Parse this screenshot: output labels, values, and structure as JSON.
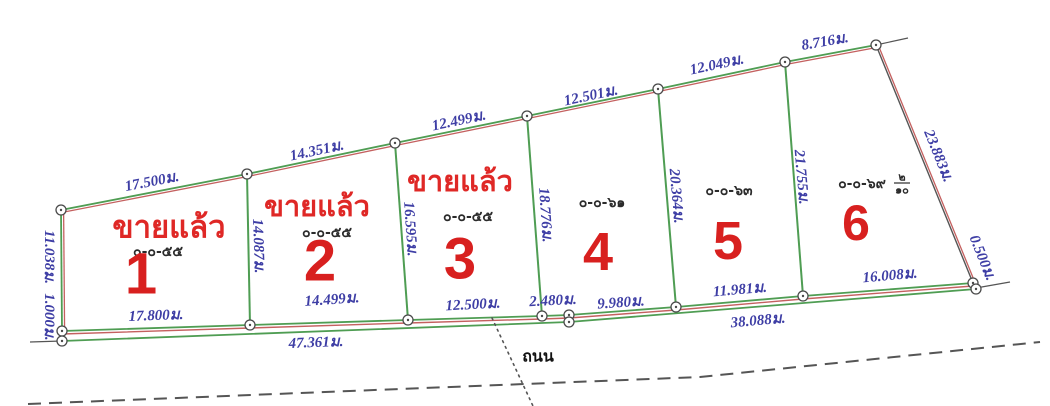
{
  "diagram": {
    "type": "land-subdivision-survey-plan",
    "unit_suffix": "ม.",
    "colors": {
      "green": "#4f9d53",
      "red": "#c4605f",
      "dark": "#555555",
      "dim_text": "#3e3ea5",
      "sold_red": "#df2826",
      "number_red": "#d8201f",
      "area_text": "#2b2b2b",
      "road_text": "#111111",
      "background": "#ffffff"
    },
    "road": {
      "label": "ถนน",
      "x": 538,
      "y": 356
    },
    "plots": [
      {
        "number": "1",
        "sold_label": "ขายแล้ว",
        "area_label": "๐-๐-๕๕",
        "sold_xy": [
          169,
          227
        ],
        "sold_size": 31,
        "area_xy": [
          158,
          252
        ],
        "number_xy": [
          141,
          274
        ],
        "number_size": 58
      },
      {
        "number": "2",
        "sold_label": "ขายแล้ว",
        "area_label": "๐-๐-๕๕",
        "sold_xy": [
          317,
          207
        ],
        "sold_size": 29,
        "area_xy": [
          327,
          233
        ],
        "number_xy": [
          320,
          261
        ],
        "number_size": 58
      },
      {
        "number": "3",
        "sold_label": "ขายแล้ว",
        "area_label": "๐-๐-๕๕",
        "sold_xy": [
          460,
          182
        ],
        "sold_size": 29,
        "area_xy": [
          468,
          217
        ],
        "number_xy": [
          460,
          259
        ],
        "number_size": 58
      },
      {
        "number": "4",
        "area_label": "๐-๐-๖๑",
        "area_xy": [
          602,
          203
        ],
        "number_xy": [
          598,
          252
        ],
        "number_size": 54
      },
      {
        "number": "5",
        "area_label": "๐-๐-๖๓",
        "area_xy": [
          729,
          191
        ],
        "number_xy": [
          728,
          241
        ],
        "number_size": 54
      },
      {
        "number": "6",
        "area_label": "๐-๐-๖๙",
        "area_xy": [
          862,
          184
        ],
        "area_fraction": {
          "num": "๒",
          "den": "๑๐",
          "x": 902,
          "y": 184
        },
        "number_xy": [
          856,
          223
        ],
        "number_size": 50
      }
    ],
    "dimension_labels": [
      {
        "t": "17.500ม.",
        "x": 152,
        "y": 182,
        "r": -11
      },
      {
        "t": "14.351ม.",
        "x": 317,
        "y": 151,
        "r": -12
      },
      {
        "t": "12.499ม.",
        "x": 459,
        "y": 121,
        "r": -12
      },
      {
        "t": "12.501ม.",
        "x": 591,
        "y": 96,
        "r": -12
      },
      {
        "t": "12.049ม.",
        "x": 717,
        "y": 65,
        "r": -12
      },
      {
        "t": "8.716ม.",
        "x": 825,
        "y": 42,
        "r": -10
      },
      {
        "t": "23.883ม.",
        "x": 938,
        "y": 156,
        "r": 68
      },
      {
        "t": "0.500ม.",
        "x": 982,
        "y": 258,
        "r": 68
      },
      {
        "t": "11.038ม.",
        "x": 49,
        "y": 257,
        "r": 90
      },
      {
        "t": "1.000ม.",
        "x": 49,
        "y": 317,
        "r": 90
      },
      {
        "t": "14.087ม.",
        "x": 258,
        "y": 246,
        "r": 88
      },
      {
        "t": "16.595ม.",
        "x": 410,
        "y": 229,
        "r": 86
      },
      {
        "t": "18.776ม.",
        "x": 545,
        "y": 215,
        "r": 86
      },
      {
        "t": "20.364ม.",
        "x": 676,
        "y": 196,
        "r": 85
      },
      {
        "t": "21.755ม.",
        "x": 801,
        "y": 177,
        "r": 85
      },
      {
        "t": "17.800ม.",
        "x": 156,
        "y": 316,
        "r": -2
      },
      {
        "t": "14.499ม.",
        "x": 332,
        "y": 300,
        "r": -4
      },
      {
        "t": "12.500ม.",
        "x": 473,
        "y": 305,
        "r": -3
      },
      {
        "t": "2.480ม.",
        "x": 553,
        "y": 301,
        "r": -3
      },
      {
        "t": "9.980ม.",
        "x": 621,
        "y": 303,
        "r": -4
      },
      {
        "t": "11.981ม.",
        "x": 740,
        "y": 290,
        "r": -5
      },
      {
        "t": "16.008ม.",
        "x": 890,
        "y": 276,
        "r": -5
      },
      {
        "t": "47.361ม.",
        "x": 316,
        "y": 343,
        "r": -2
      },
      {
        "t": "38.088ม.",
        "x": 758,
        "y": 321,
        "r": -5
      }
    ],
    "geometry": {
      "lines": [
        {
          "name": "top-boundary-green",
          "color": "green",
          "w": 1.8,
          "points": [
            [
              61,
              210
            ],
            [
              247,
              174
            ],
            [
              395,
              143
            ],
            [
              527,
              116
            ],
            [
              658,
              89
            ],
            [
              785,
              62
            ],
            [
              876,
              45
            ]
          ]
        },
        {
          "name": "top-boundary-red",
          "color": "red",
          "w": 1.3,
          "off": [
            0,
            2.6
          ],
          "points": [
            [
              61,
              210
            ],
            [
              247,
              174
            ],
            [
              395,
              143
            ],
            [
              527,
              116
            ],
            [
              658,
              89
            ],
            [
              785,
              62
            ],
            [
              876,
              45
            ]
          ]
        },
        {
          "name": "left-boundary-green",
          "color": "green",
          "w": 1.8,
          "points": [
            [
              61,
              210
            ],
            [
              62,
              331
            ]
          ]
        },
        {
          "name": "left-boundary-red",
          "color": "red",
          "w": 1.3,
          "off": [
            2.6,
            0
          ],
          "points": [
            [
              61,
              210
            ],
            [
              62,
              331
            ]
          ]
        },
        {
          "name": "right-boundary-dark",
          "color": "dark",
          "w": 1.4,
          "points": [
            [
              876,
              45
            ],
            [
              973,
              283
            ]
          ]
        },
        {
          "name": "right-boundary-red",
          "color": "red",
          "w": 1.3,
          "off": [
            2.6,
            1
          ],
          "points": [
            [
              876,
              45
            ],
            [
              973,
              283
            ]
          ]
        },
        {
          "name": "right-gap-segment",
          "color": "dark",
          "w": 1.4,
          "points": [
            [
              973,
              283
            ],
            [
              976,
              289
            ]
          ]
        },
        {
          "name": "bottom-inner-green",
          "color": "green",
          "w": 1.8,
          "points": [
            [
              62,
              331
            ],
            [
              250,
              325
            ],
            [
              408,
              320
            ],
            [
              542,
              316
            ],
            [
              569,
              315
            ],
            [
              676,
              307
            ],
            [
              803,
              296
            ],
            [
              973,
              283
            ]
          ]
        },
        {
          "name": "bottom-boundary-red",
          "color": "red",
          "w": 1.4,
          "off": [
            0,
            3
          ],
          "points": [
            [
              62,
              331
            ],
            [
              250,
              325
            ],
            [
              408,
              320
            ],
            [
              542,
              316
            ],
            [
              569,
              315
            ],
            [
              676,
              307
            ],
            [
              803,
              296
            ],
            [
              973,
              283
            ]
          ]
        },
        {
          "name": "bottom-outer-green",
          "color": "green",
          "w": 1.8,
          "points": [
            [
              62,
              341
            ],
            [
              569,
              322
            ],
            [
              976,
              289
            ]
          ]
        },
        {
          "name": "divider-plot1-plot2",
          "color": "green",
          "w": 2,
          "points": [
            [
              247,
              174
            ],
            [
              250,
              325
            ]
          ]
        },
        {
          "name": "divider-plot2-plot3",
          "color": "green",
          "w": 2,
          "points": [
            [
              395,
              143
            ],
            [
              408,
              320
            ]
          ]
        },
        {
          "name": "divider-plot3-plot4",
          "color": "green",
          "w": 2,
          "points": [
            [
              527,
              116
            ],
            [
              542,
              316
            ]
          ]
        },
        {
          "name": "divider-plot4-plot5",
          "color": "green",
          "w": 2,
          "points": [
            [
              658,
              89
            ],
            [
              676,
              307
            ]
          ]
        },
        {
          "name": "divider-plot5-plot6",
          "color": "green",
          "w": 2,
          "points": [
            [
              785,
              62
            ],
            [
              803,
              296
            ]
          ]
        },
        {
          "name": "tick-top-right",
          "color": "dark",
          "w": 1.2,
          "points": [
            [
              876,
              45
            ],
            [
              908,
              38
            ]
          ]
        },
        {
          "name": "tick-bottom-right",
          "color": "dark",
          "w": 1.2,
          "points": [
            [
              976,
              288
            ],
            [
              1010,
              282
            ]
          ]
        },
        {
          "name": "tick-bottom-left",
          "color": "dark",
          "w": 1.2,
          "points": [
            [
              62,
              341
            ],
            [
              30,
              342
            ]
          ]
        },
        {
          "name": "road-edge-dashed",
          "color": "dark",
          "w": 2,
          "dash": "13 8",
          "points": [
            [
              28,
              404
            ],
            [
              350,
              391
            ],
            [
              700,
              377
            ],
            [
              1040,
              342
            ]
          ]
        },
        {
          "name": "survey-dotted-line",
          "color": "dark",
          "w": 1.6,
          "dash": "1.8 4.5",
          "cap": "round",
          "points": [
            [
              492,
              318
            ],
            [
              533,
              406
            ]
          ]
        }
      ],
      "vertices": [
        [
          61,
          210
        ],
        [
          247,
          174
        ],
        [
          395,
          143
        ],
        [
          527,
          116
        ],
        [
          658,
          89
        ],
        [
          785,
          62
        ],
        [
          876,
          45
        ],
        [
          62,
          331
        ],
        [
          62,
          341
        ],
        [
          250,
          325
        ],
        [
          408,
          320
        ],
        [
          542,
          316
        ],
        [
          569,
          315
        ],
        [
          569,
          322
        ],
        [
          676,
          307
        ],
        [
          803,
          296
        ],
        [
          973,
          283
        ],
        [
          976,
          289
        ]
      ]
    }
  }
}
